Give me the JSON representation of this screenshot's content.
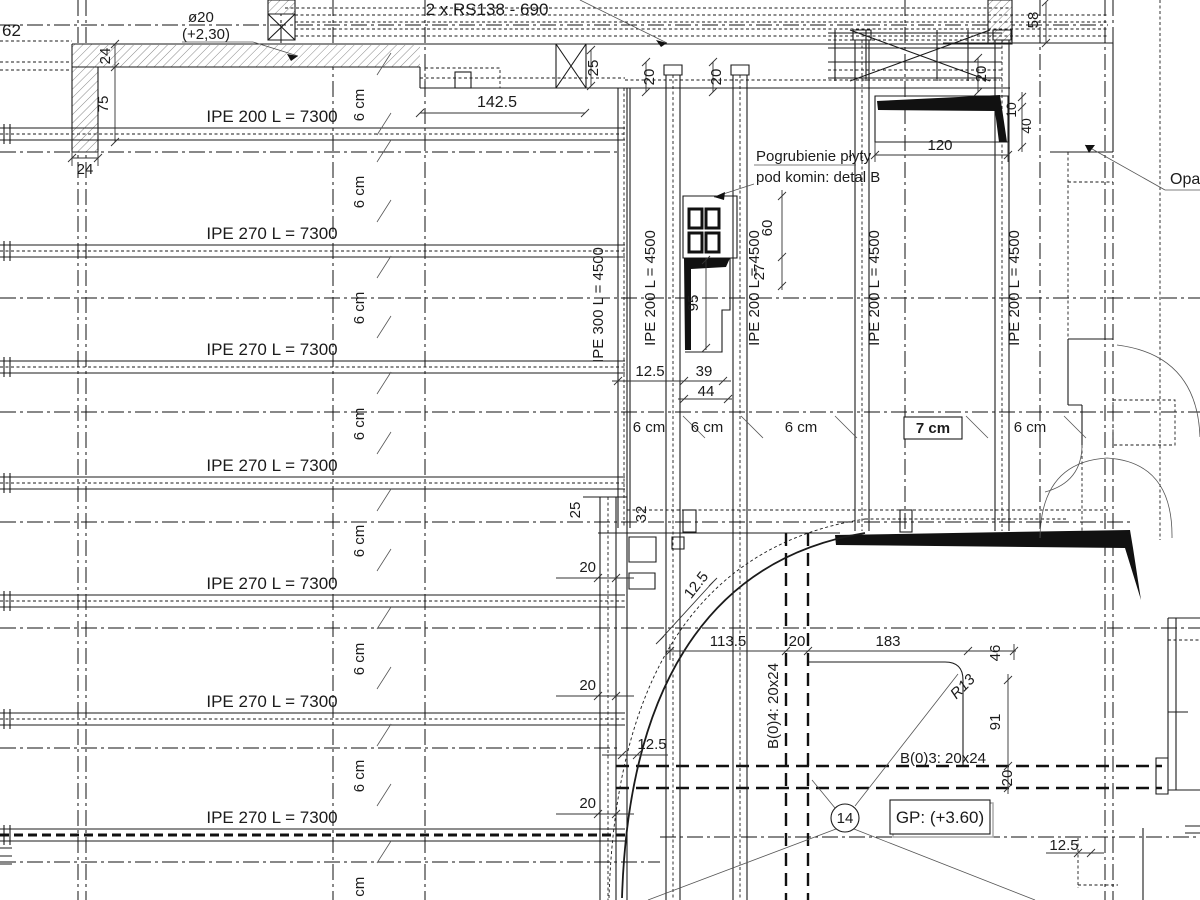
{
  "plan": {
    "top_note": "2 x RS138 - 690",
    "grid_mark_left": "62",
    "rebar_note": {
      "dia": "ø20",
      "level": "(+2,30)"
    },
    "chimney_note": {
      "line1": "Pogrubienie płyty",
      "line2": "pod komin: detal B"
    },
    "support_note": "Opar",
    "grid_bubble": "14",
    "level_mark": "GP: (+3.60)",
    "radius_mark": "R13",
    "beam_b04": "B(0)4: 20x24",
    "beam_b03": "B(0)3: 20x24"
  },
  "left_beams": [
    {
      "label": "IPE 200 L = 7300"
    },
    {
      "label": "IPE 270 L = 7300"
    },
    {
      "label": "IPE 270 L = 7300"
    },
    {
      "label": "IPE 270 L = 7300"
    },
    {
      "label": "IPE 270 L = 7300"
    },
    {
      "label": "IPE 270 L = 7300"
    },
    {
      "label": "IPE 270 L = 7300"
    }
  ],
  "vertical_beams": [
    {
      "label": "IPE 300 L = 4500"
    },
    {
      "label": "IPE 200 L = 4500"
    },
    {
      "label": "IPE 200 L = 4500"
    },
    {
      "label": "IPE 200 L = 4500"
    },
    {
      "label": "IPE 200 L = 4500"
    }
  ],
  "slab_thickness_column": [
    "6 cm",
    "6 cm",
    "6 cm",
    "6 cm",
    "6 cm",
    "6 cm",
    "6 cm",
    "6 cm"
  ],
  "slab_thickness_row": [
    "6 cm",
    "6 cm",
    "6 cm",
    "7 cm",
    "6 cm"
  ],
  "dims": {
    "d24_top": "24",
    "d75": "75",
    "d24_bottom": "24",
    "d142_5": "142.5",
    "d25_top": "25",
    "d20_a": "20",
    "d20_b": "20",
    "d20_c": "20",
    "d58": "58",
    "d120": "120",
    "d10": "10",
    "d40": "40",
    "d60": "60",
    "d27": "27",
    "d95": "95",
    "d12_5_chimney": "12.5",
    "d39": "39",
    "d44": "44",
    "d25_wall": "25",
    "d32": "32",
    "d20_w1": "20",
    "d20_w2": "20",
    "d20_w3": "20",
    "d12_5_wall": "12.5",
    "d12_5_curve": "12.5",
    "d113_5": "113.5",
    "d20_d": "20",
    "d183": "183",
    "d46": "46",
    "d91": "91",
    "d20_e": "20",
    "d12_5_br": "12.5"
  },
  "colors": {
    "line": "#1b1b1b",
    "hatch": "#8a8a8a",
    "background": "#ffffff"
  }
}
